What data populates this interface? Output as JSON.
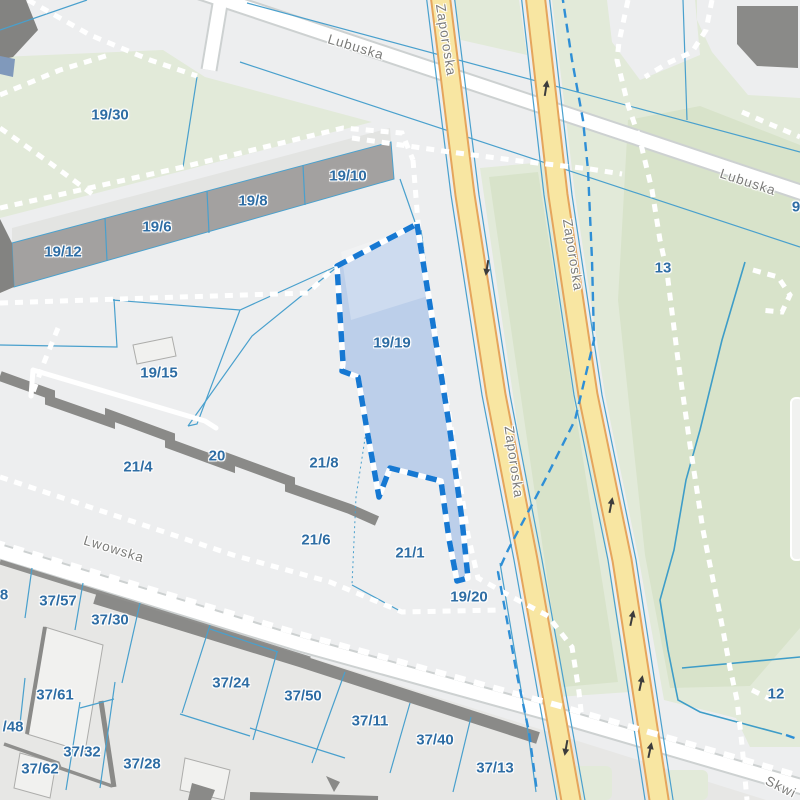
{
  "map": {
    "selected_parcel": "19/19",
    "parcel_labels": [
      {
        "text": "19/30",
        "x": 110,
        "y": 115
      },
      {
        "text": "19/12",
        "x": 63,
        "y": 252
      },
      {
        "text": "19/6",
        "x": 157,
        "y": 227
      },
      {
        "text": "19/8",
        "x": 253,
        "y": 201
      },
      {
        "text": "19/10",
        "x": 348,
        "y": 176
      },
      {
        "text": "19/15",
        "x": 159,
        "y": 373
      },
      {
        "text": "19/19",
        "x": 392,
        "y": 343
      },
      {
        "text": "21/4",
        "x": 138,
        "y": 467
      },
      {
        "text": "20",
        "x": 217,
        "y": 456
      },
      {
        "text": "21/8",
        "x": 324,
        "y": 463
      },
      {
        "text": "21/6",
        "x": 316,
        "y": 540
      },
      {
        "text": "21/1",
        "x": 410,
        "y": 553
      },
      {
        "text": "19/20",
        "x": 469,
        "y": 597
      },
      {
        "text": "13",
        "x": 663,
        "y": 268
      },
      {
        "text": "12",
        "x": 776,
        "y": 694
      },
      {
        "text": "9",
        "x": 796,
        "y": 207
      },
      {
        "text": "8",
        "x": 4,
        "y": 595
      },
      {
        "text": "/48",
        "x": 13,
        "y": 727
      },
      {
        "text": "37/57",
        "x": 58,
        "y": 601
      },
      {
        "text": "37/30",
        "x": 110,
        "y": 620
      },
      {
        "text": "37/61",
        "x": 55,
        "y": 695
      },
      {
        "text": "37/32",
        "x": 82,
        "y": 752
      },
      {
        "text": "37/62",
        "x": 40,
        "y": 769
      },
      {
        "text": "37/28",
        "x": 142,
        "y": 764
      },
      {
        "text": "37/24",
        "x": 231,
        "y": 683
      },
      {
        "text": "37/50",
        "x": 303,
        "y": 696
      },
      {
        "text": "37/11",
        "x": 370,
        "y": 721
      },
      {
        "text": "37/40",
        "x": 435,
        "y": 740
      },
      {
        "text": "37/13",
        "x": 495,
        "y": 768
      }
    ],
    "street_labels": [
      {
        "text": "Lubuska",
        "x": 356,
        "y": 47,
        "rot": 17
      },
      {
        "text": "Lubuska",
        "x": 748,
        "y": 182,
        "rot": 18
      },
      {
        "text": "Zaporoska",
        "x": 446,
        "y": 40,
        "rot": 81
      },
      {
        "text": "Zaporoska",
        "x": 573,
        "y": 255,
        "rot": 81
      },
      {
        "text": "Zaporoska",
        "x": 514,
        "y": 462,
        "rot": 82
      },
      {
        "text": "Lwowska",
        "x": 114,
        "y": 549,
        "rot": 17
      },
      {
        "text": "Skwi",
        "x": 781,
        "y": 787,
        "rot": 26
      }
    ],
    "icons": {
      "one_way_arrow": "one-way-arrow"
    },
    "colors": {
      "parcel_label": "#2E6DA4",
      "street_label": "#7C7C7A",
      "selection_fill": "#AFC7E8",
      "selection_border": "#1678D2",
      "road_yellow": "#F8E6A2",
      "road_casing": "#E5A55C",
      "green": "#E2EAD9",
      "green_dark": "#D8E3CA",
      "parcel_line": "#49A0CD",
      "boundary_dash": "#2F8FD6"
    }
  }
}
